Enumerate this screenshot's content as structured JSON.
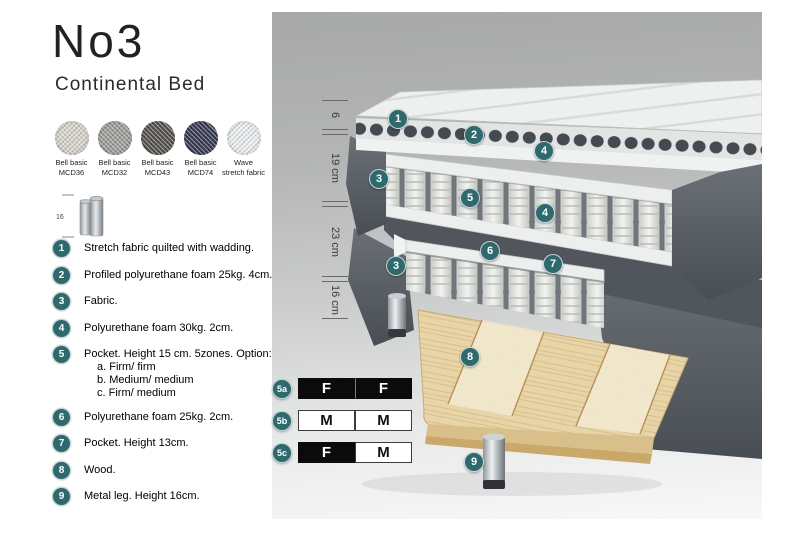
{
  "header": {
    "title": "No3",
    "subtitle": "Continental Bed"
  },
  "colors": {
    "accent_teal": "#2d6a6d",
    "panel_gray_top": "#a7a8a8",
    "panel_gray_bottom": "#f8f8f8",
    "fabric_dark": "#565b61",
    "wood": "#e7d4a7",
    "metal": "#aab0b4"
  },
  "swatches": [
    {
      "line1": "Bell basic",
      "line2": "MCD36",
      "color": "#d7d4ca"
    },
    {
      "line1": "Bell basic",
      "line2": "MCD32",
      "color": "#9d9d9a"
    },
    {
      "line1": "Bell basic",
      "line2": "MCD43",
      "color": "#56534d"
    },
    {
      "line1": "Bell basic",
      "line2": "MCD74",
      "color": "#383b53"
    },
    {
      "line1": "Wave",
      "line2": "stretch fabric",
      "color": "#eceff0"
    }
  ],
  "leg_icon": {
    "dimension": "16"
  },
  "legend": {
    "items": [
      {
        "n": "1",
        "text": "Stretch fabric quilted with wadding."
      },
      {
        "n": "2",
        "text": "Profiled polyurethane foam 25kg. 4cm."
      },
      {
        "n": "3",
        "text": "Fabric."
      },
      {
        "n": "4",
        "text": "Polyurethane foam 30kg. 2cm."
      },
      {
        "n": "5",
        "text": "Pocket. Height 15 cm. 5zones. Option:",
        "options": [
          "a. Firm/ firm",
          "b. Medium/ medium",
          "c. Firm/ medium"
        ]
      },
      {
        "n": "6",
        "text": "Polyurethane foam 25kg. 2cm."
      },
      {
        "n": "7",
        "text": "Pocket. Height 13cm."
      },
      {
        "n": "8",
        "text": "Wood."
      },
      {
        "n": "9",
        "text": "Metal leg. Height 16cm."
      }
    ]
  },
  "diagram": {
    "badges": [
      "1",
      "2",
      "4",
      "3",
      "5",
      "4",
      "6",
      "3",
      "7",
      "8",
      "9"
    ],
    "dimensions": [
      "6",
      "19 cm",
      "23 cm",
      "16 cm"
    ]
  },
  "firmness": {
    "rows": [
      {
        "label": "5a",
        "cells": [
          {
            "text": "F",
            "filled": true
          },
          {
            "text": "F",
            "filled": true
          }
        ]
      },
      {
        "label": "5b",
        "cells": [
          {
            "text": "M",
            "filled": false
          },
          {
            "text": "M",
            "filled": false
          }
        ]
      },
      {
        "label": "5c",
        "cells": [
          {
            "text": "F",
            "filled": true
          },
          {
            "text": "M",
            "filled": false
          }
        ]
      }
    ]
  },
  "footer": {
    "version": "2022.04"
  }
}
